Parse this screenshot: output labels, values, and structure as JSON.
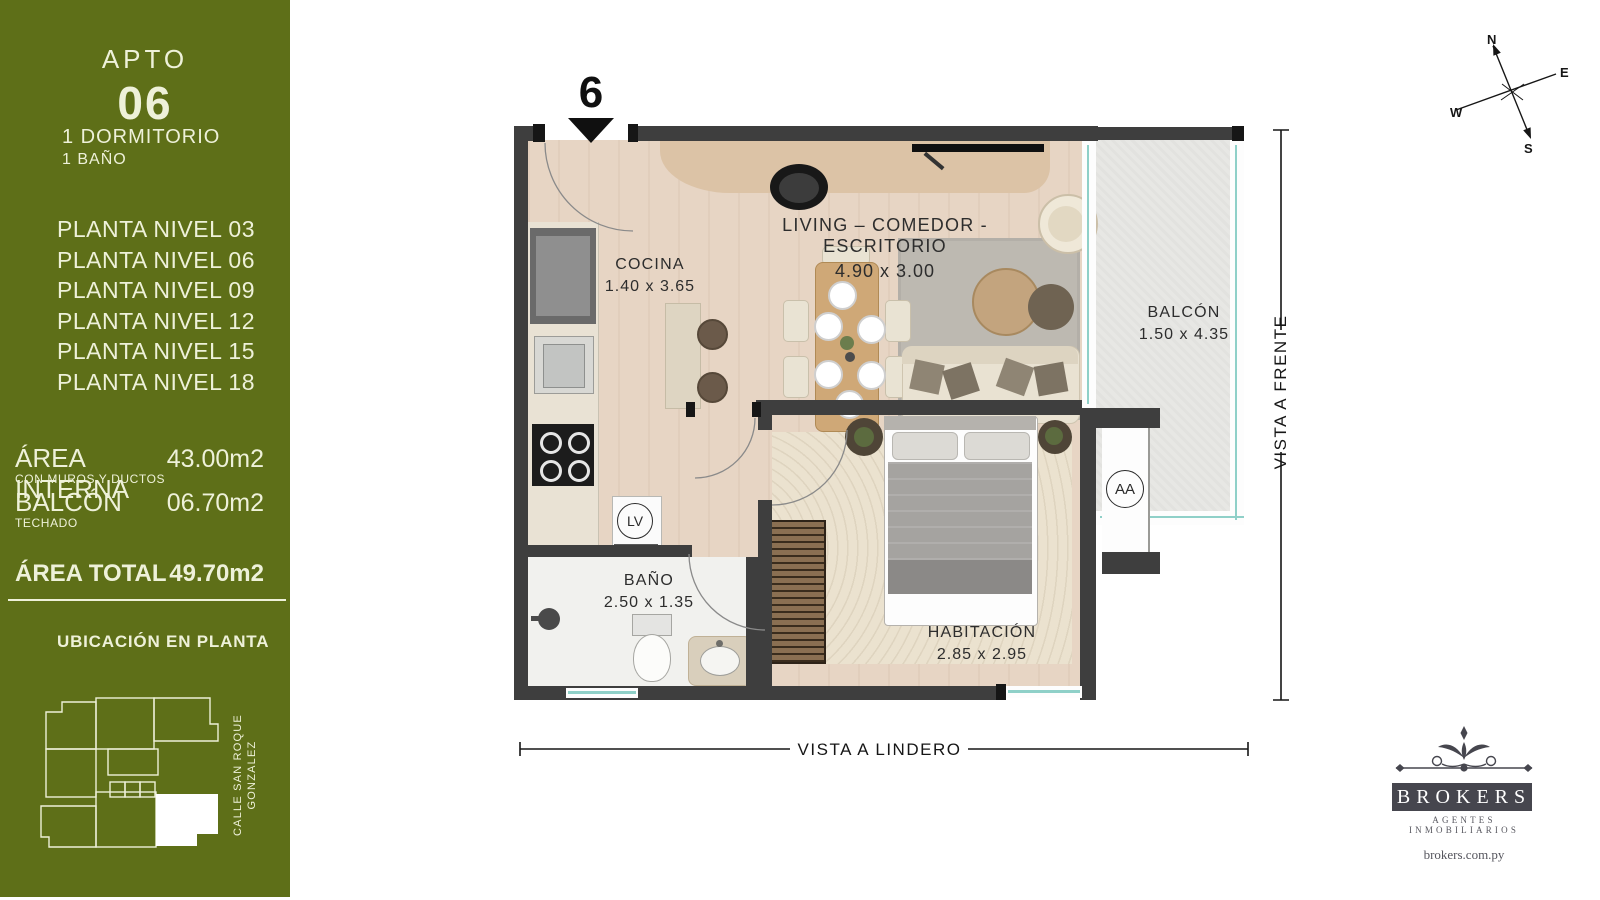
{
  "sidebar": {
    "apto_label": "APTO",
    "apto_number": "06",
    "bedrooms": "1 DORMITORIO",
    "baths": "1 BAÑO",
    "levels": [
      "PLANTA NIVEL 03",
      "PLANTA NIVEL 06",
      "PLANTA NIVEL 09",
      "PLANTA NIVEL 12",
      "PLANTA NIVEL 15",
      "PLANTA NIVEL 18"
    ],
    "area_interna": {
      "label": "ÁREA INTERNA",
      "sub": "CON MUROS Y DUCTOS",
      "value": "43.00m2"
    },
    "balcon": {
      "label": "BALCÓN",
      "sub": "TECHADO",
      "value": "06.70m2"
    },
    "area_total": {
      "label": "ÁREA TOTAL",
      "value": "49.70m2"
    },
    "ubicacion_title": "UBICACIÓN EN PLANTA",
    "street_line1": "CALLE SAN ROQUE",
    "street_line2": "GONZALEZ"
  },
  "plan": {
    "unit_marker": "6",
    "rooms": {
      "cocina": {
        "name": "COCINA",
        "dims": "1.40 x 3.65"
      },
      "living": {
        "name": "LIVING – COMEDOR - ESCRITORIO",
        "dims": "4.90 x 3.00"
      },
      "balcon": {
        "name": "BALCÓN",
        "dims": "1.50 x 4.35"
      },
      "bano": {
        "name": "BAÑO",
        "dims": "2.50 x 1.35"
      },
      "habitacion": {
        "name": "HABITACIÓN",
        "dims": "2.85 x 2.95"
      }
    },
    "badges": {
      "laundry": "LV",
      "ac": "AA"
    },
    "vista_frente": "VISTA A FRENTE",
    "vista_lindero": "VISTA A LINDERO"
  },
  "compass": {
    "n": "N",
    "e": "E",
    "s": "S",
    "w": "W"
  },
  "logo": {
    "name": "BROKERS",
    "tagline": "AGENTES INMOBILIARIOS",
    "website": "brokers.com.py"
  },
  "colors": {
    "sidebar_green": "#5e6f18",
    "wall": "#3e3e3e",
    "accent_teal": "#8fd0c8",
    "cream_text": "#eef1d9"
  }
}
